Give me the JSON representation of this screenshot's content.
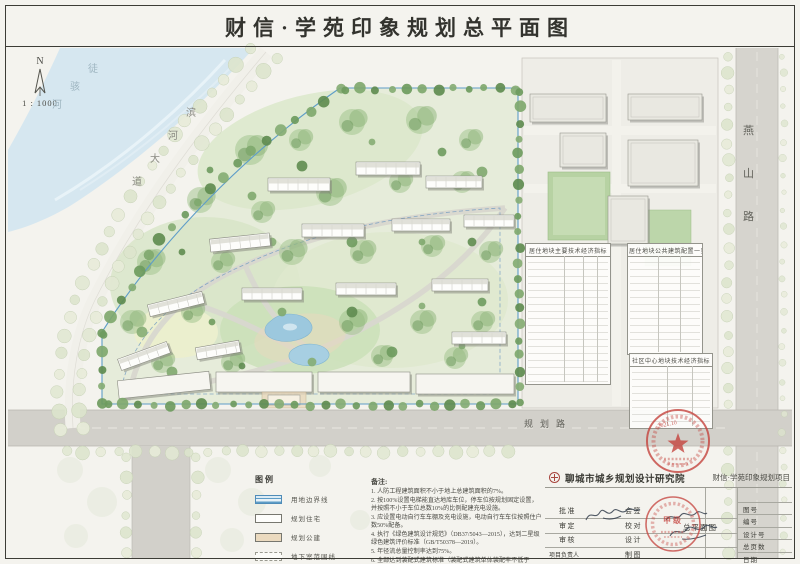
{
  "sheet": {
    "title": "财信·学苑印象规划总平面图"
  },
  "compass": {
    "north": "N",
    "scale": "1 : 1000"
  },
  "map": {
    "river": "徒骇河",
    "road_west": "滨河大道",
    "road_east": "燕山路",
    "road_south": "规划路",
    "tables": [
      {
        "title": "居住地块主要技术经济指标"
      },
      {
        "title": "居住地块公共建筑配置一览表"
      },
      {
        "title": "社区中心地块技术经济指标"
      }
    ],
    "approval_stamp": {
      "date": "2021.10",
      "color": "#c4403a"
    },
    "buildings": {
      "res": [
        [
          268,
          178,
          62,
          13,
          0
        ],
        [
          356,
          162,
          64,
          13,
          0
        ],
        [
          426,
          176,
          56,
          12,
          0
        ],
        [
          210,
          236,
          60,
          13,
          -6
        ],
        [
          302,
          224,
          62,
          13,
          0
        ],
        [
          392,
          219,
          58,
          12,
          0
        ],
        [
          464,
          215,
          50,
          12,
          0
        ],
        [
          148,
          298,
          56,
          12,
          -14
        ],
        [
          242,
          288,
          60,
          12,
          0
        ],
        [
          336,
          283,
          60,
          12,
          0
        ],
        [
          432,
          279,
          56,
          12,
          0
        ],
        [
          118,
          350,
          52,
          12,
          -20
        ],
        [
          196,
          344,
          44,
          12,
          -10
        ],
        [
          452,
          332,
          54,
          12,
          0
        ]
      ],
      "com": [
        [
          118,
          376,
          92,
          18,
          -6
        ],
        [
          216,
          372,
          96,
          20,
          0
        ],
        [
          318,
          372,
          92,
          20,
          0
        ],
        [
          416,
          374,
          98,
          20,
          0
        ]
      ],
      "pub": [
        [
          530,
          94,
          76,
          28,
          0
        ],
        [
          628,
          94,
          74,
          26,
          0
        ],
        [
          560,
          133,
          46,
          34,
          0
        ],
        [
          628,
          140,
          70,
          46,
          0
        ],
        [
          608,
          196,
          40,
          48,
          0
        ]
      ]
    }
  },
  "legend": {
    "title": "图例",
    "items": [
      {
        "label": "用地边界线",
        "swatch": "boundary"
      },
      {
        "label": "规划住宅",
        "swatch": "residential"
      },
      {
        "label": "规划公建",
        "swatch": "public"
      },
      {
        "label": "地下室范围线",
        "swatch": "basement"
      }
    ]
  },
  "notes": {
    "title": "备注:",
    "items": [
      "人防工程建筑面积不小于地上总建筑面积的7%。",
      "按100%设置电梯能直达地库车位，停车位按规划固定设置，并按照不小于车位总数10%的比例配建充电设施。",
      "应设置电动自行车车棚及充电设施，电动自行车车位按照住户数50%配备。",
      "执行《绿色建筑设计规范》（DB37/5043—2015），达到二星级绿色建筑评价标准（GB/T50378—2019）。",
      "年径流总量控制率达到75%。",
      "全部达到装配式建筑标准（装配式建筑单体装配率不低于70%）。"
    ]
  },
  "title_block": {
    "company": "聊城市城乡规划设计研究院",
    "project": "财信·学苑印象规划项目",
    "drawing_name": "总平面图",
    "left_labels": [
      "批准",
      "审定",
      "审核",
      "项目负责人"
    ],
    "mid_labels": [
      "会签",
      "校对",
      "设计",
      "制图"
    ],
    "right_labels": [
      "图号",
      "编号",
      "设计号",
      "总页数",
      "日期"
    ],
    "cert_stamp_label": "甲级"
  },
  "colors": {
    "stamp_red": "#c4403a",
    "boundary_blue": "#5e9dc8",
    "public_tan": "#ebdabf",
    "water_blue": "#9cc8de",
    "river_blue": "#d6e7f0"
  }
}
